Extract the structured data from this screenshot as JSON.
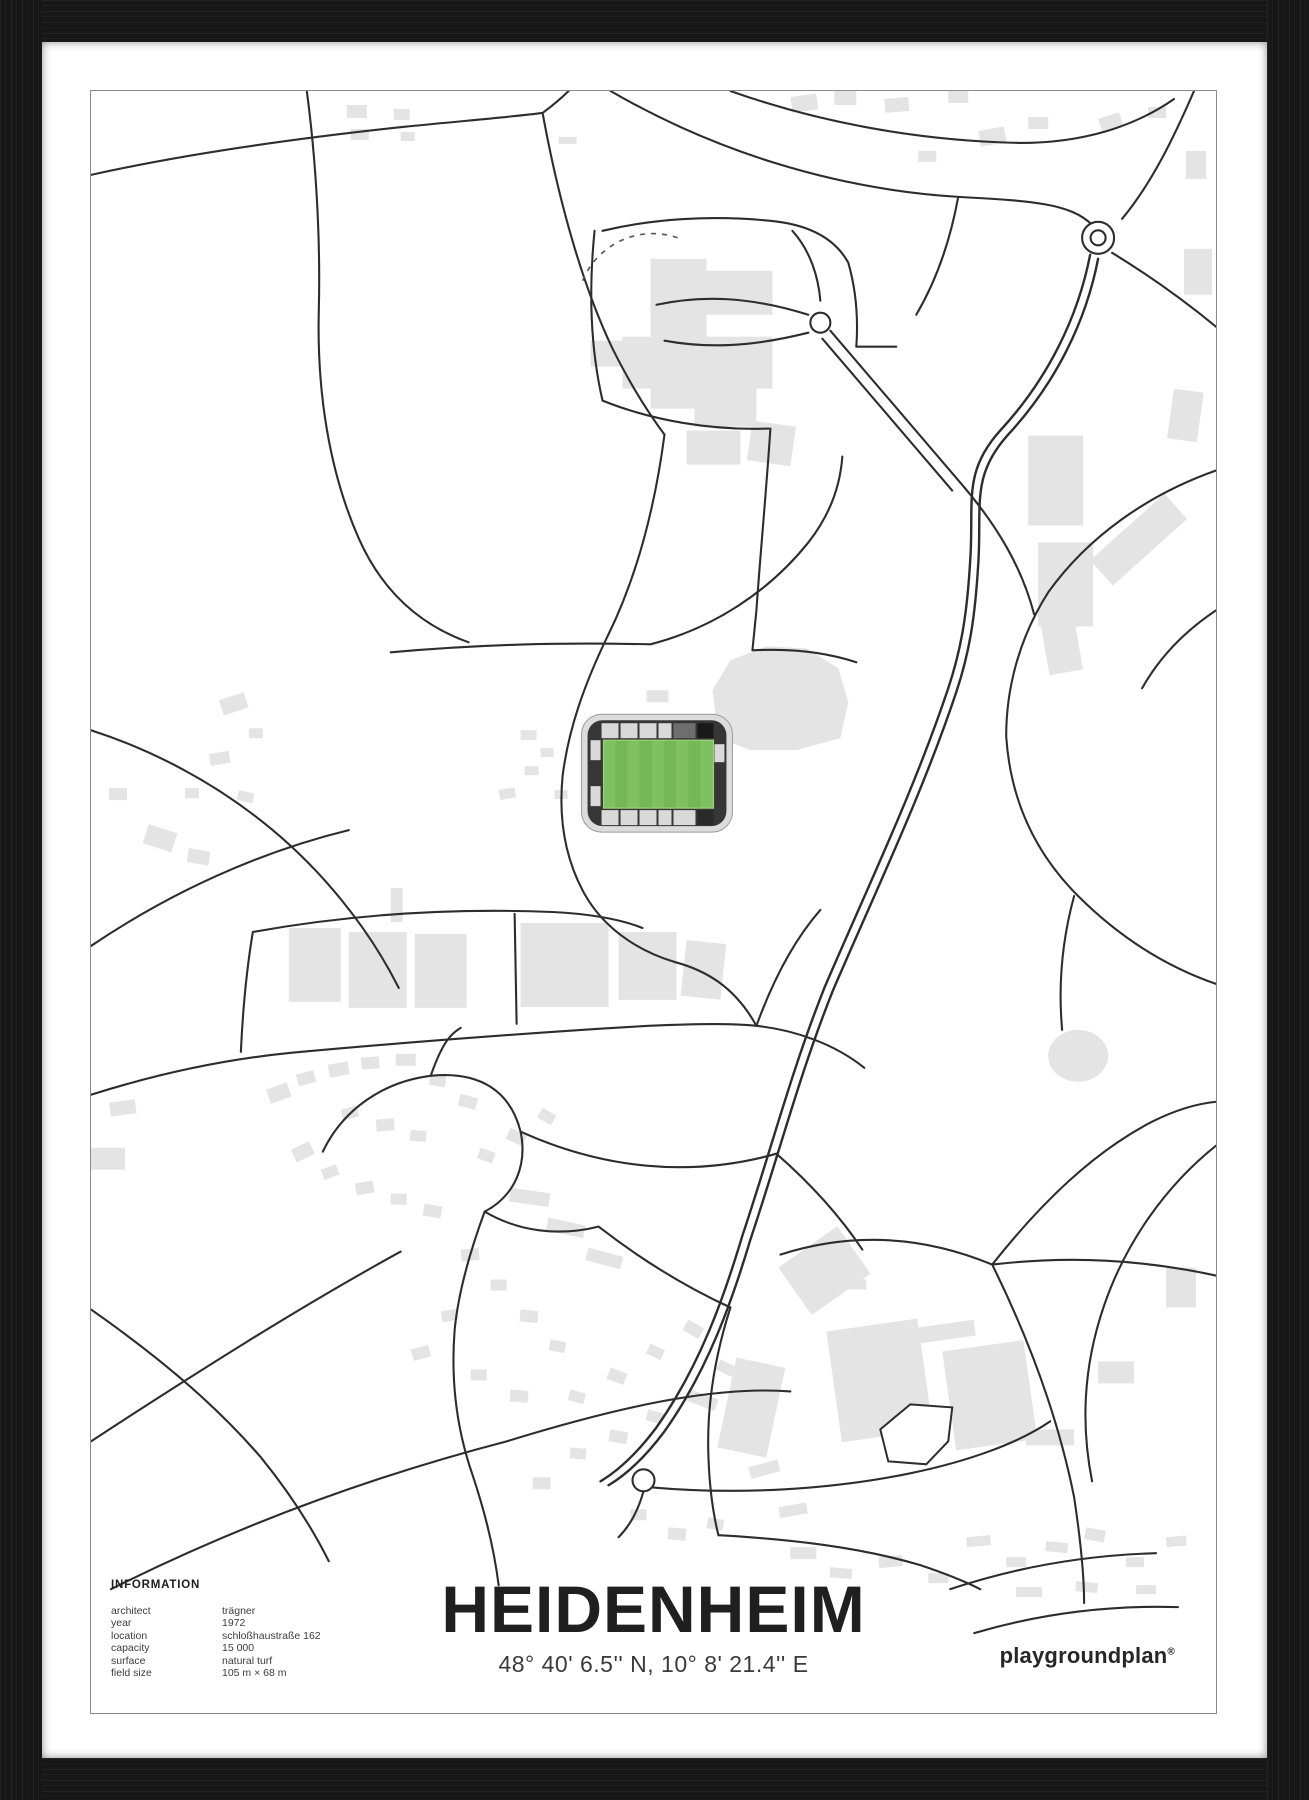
{
  "poster": {
    "title": "HEIDENHEIM",
    "coordinates": "48° 40' 6.5'' N, 10° 8' 21.4'' E",
    "brand": {
      "name": "playgroundplan",
      "mark": "®"
    },
    "info": {
      "heading": "INFORMATION",
      "rows": [
        {
          "label": "architect",
          "value": "trägner"
        },
        {
          "label": "year",
          "value": "1972"
        },
        {
          "label": "location",
          "value": "schloßhaustraße 162"
        },
        {
          "label": "capacity",
          "value": "15 000"
        },
        {
          "label": "surface",
          "value": "natural turf"
        },
        {
          "label": "field size",
          "value": "105 m × 68 m"
        }
      ]
    },
    "colors": {
      "frame": "#171717",
      "matte": "#ffffff",
      "map_background": "#ffffff",
      "road": "#2d2d2d",
      "building": "#e4e4e4",
      "map_border": "#8a8a8a",
      "field_green_light": "#7fc161",
      "field_green_dark": "#73b854",
      "stand_light": "#d9d9d9",
      "stand_dark": "#363636",
      "text": "#1f1f1f"
    }
  }
}
